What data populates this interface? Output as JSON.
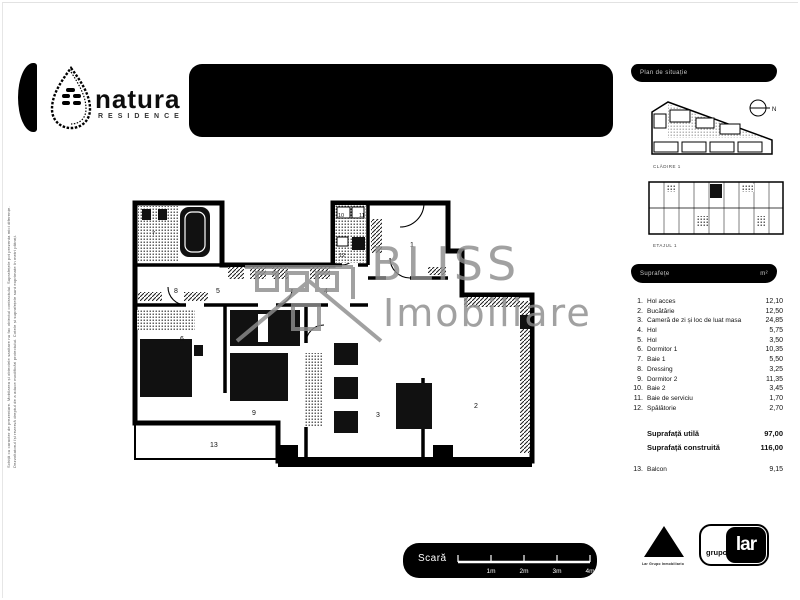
{
  "brand": {
    "name": "natura",
    "tagline": "RESIDENCE"
  },
  "sidebar": {
    "site_header": "Plan de situație",
    "compass": "N",
    "site_caption": "CLĂDIRE 1",
    "floor_caption": "ETAJUL 1",
    "areas_header": {
      "left": "Suprafețe",
      "right": "m²"
    },
    "rows": [
      {
        "no": "1.",
        "label": "Hol acces",
        "value": "12,10"
      },
      {
        "no": "2.",
        "label": "Bucătărie",
        "value": "12,50"
      },
      {
        "no": "3.",
        "label": "Cameră de zi și loc de luat masa",
        "value": "24,85"
      },
      {
        "no": "4.",
        "label": "Hol",
        "value": "5,75"
      },
      {
        "no": "5.",
        "label": "Hol",
        "value": "3,50"
      },
      {
        "no": "6.",
        "label": "Dormitor 1",
        "value": "10,35"
      },
      {
        "no": "7.",
        "label": "Baie 1",
        "value": "5,50"
      },
      {
        "no": "8.",
        "label": "Dressing",
        "value": "3,25"
      },
      {
        "no": "9.",
        "label": "Dormitor 2",
        "value": "11,35"
      },
      {
        "no": "10.",
        "label": "Baie 2",
        "value": "3,45"
      },
      {
        "no": "11.",
        "label": "Baie de serviciu",
        "value": "1,70"
      },
      {
        "no": "12.",
        "label": "Spălătorie",
        "value": "2,70"
      }
    ],
    "totals": [
      {
        "label": "Suprafață utilă",
        "value": "97,00"
      },
      {
        "label": "Suprafață construită",
        "value": "116,00"
      }
    ],
    "balcony": {
      "no": "13.",
      "label": "Balcon",
      "value": "9,15"
    }
  },
  "plan": {
    "rooms": [
      "1",
      "2",
      "3",
      "4",
      "5",
      "6",
      "7",
      "8",
      "9",
      "10",
      "11",
      "12",
      "13"
    ]
  },
  "watermark": {
    "line1": "BLISS",
    "line2": "Imobiliare"
  },
  "scalebar": {
    "label": "Scară",
    "ticks": [
      "1m",
      "2m",
      "3m",
      "4m"
    ]
  },
  "footer": {
    "triangle_caption": "Lar Grupo Inmobiliario",
    "grupo": "grupo",
    "lar": "lar"
  },
  "disclaimer": {
    "line1": "Schiță cu caracter de prezentare. Mobilarea și obiectele sanitare nu fac obiectul contractului. Suprafețele pot prezenta mici diferențe.",
    "line2": "Dezvoltatorul își rezervă dreptul de a aduce modificări proiectului. Cotele și suprafețele sunt exprimate în metri pătrați."
  },
  "colors": {
    "ink": "#000000",
    "watermark_gray": "#8d8d8d"
  }
}
